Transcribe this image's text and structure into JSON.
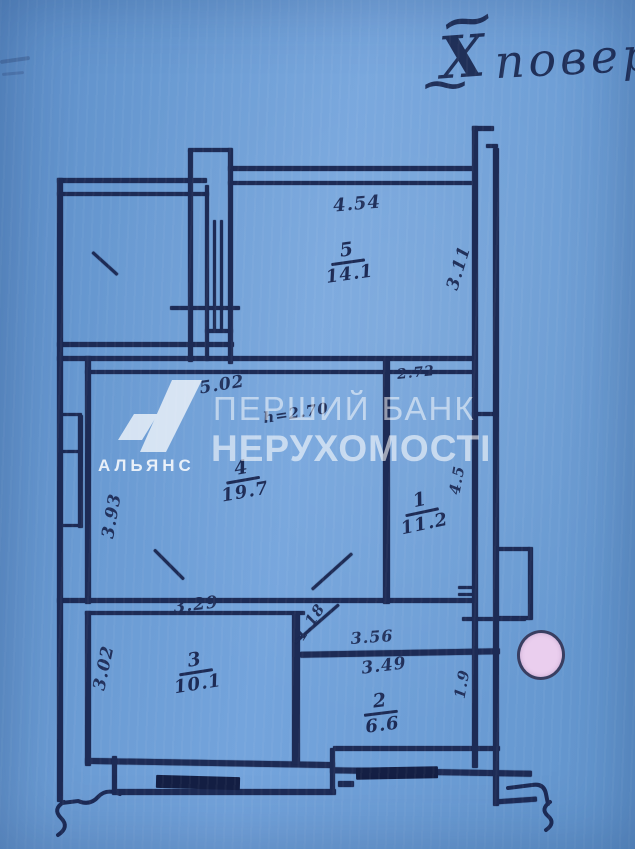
{
  "document": {
    "kind": "scanned apartment floor plan",
    "floor_annotation": {
      "tilde": "~",
      "roman_numeral": "Х",
      "word": "повер"
    }
  },
  "watermark": {
    "brand_line1": "ПЕРШИЙ БАНК",
    "brand_line2": "НЕРУХОМОСТІ",
    "logo_caption": "АЛЬЯНС"
  },
  "plan": {
    "rooms": [
      {
        "number": "5",
        "area": "14.1",
        "width": "4.54",
        "depth": "3.11"
      },
      {
        "number": "4",
        "area": "19.7",
        "width": "5.02",
        "depth": "3.93"
      },
      {
        "number": "1",
        "area": "11.2",
        "width": "2.72",
        "depth": "4.5"
      },
      {
        "number": "3",
        "area": "10.1",
        "width": "3.29",
        "depth": "3.02"
      },
      {
        "number": "2",
        "area": "6.6",
        "width": "3.49",
        "depth": "1.9"
      }
    ],
    "notes": {
      "ceiling_height": "h=2.70",
      "hallway_width": "3.56",
      "door_diagonal": "1.18"
    }
  },
  "colors": {
    "paper_blue": "#6b9cd4",
    "ink_navy": "#1d2b55",
    "watermark_white": "#ffffff",
    "marker_dot_pink": "#eaceee"
  }
}
